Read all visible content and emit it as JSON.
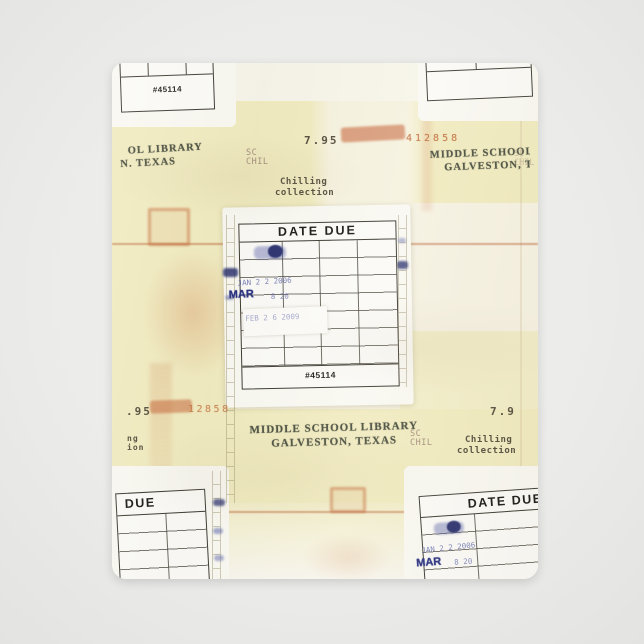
{
  "scene": {
    "subject": "Fleece blanket printed with a vintage library date-due book pocket collage",
    "background_color": "#ececea",
    "blanket_cream": "#f6f2df",
    "tile_yellow": "#f1ebc0",
    "card_paper": "#fbfaf6",
    "ink_dark": "#3f3c33",
    "stamp_green_ink": "#4c5140",
    "stamp_red": "#bf6330",
    "stamp_blue": "#5f68ab",
    "stain_rust": "#c66c38"
  },
  "cards": {
    "center": {
      "header": "DATE DUE",
      "footer": "#45114",
      "stamps": {
        "jan": "JAN 2 2 2006",
        "mar_month": "MAR",
        "mar_rest": "8 20",
        "feb": "FEB 2 6 2009"
      }
    },
    "top_left": {
      "footer": "#45114"
    },
    "bottom_left": {
      "header_fragment": "DUE"
    },
    "bottom_right": {
      "header": "DATE DUE",
      "stamps": {
        "jan": "JAN 2 2 2006",
        "mar_month": "MAR",
        "mar_rest": "8 20"
      }
    }
  },
  "pocket": {
    "library_stamp": {
      "line1": "MIDDLE SCHOOL LIBRARY",
      "line2": "GALVESTON, TEXAS"
    },
    "library_stamp_fragment": {
      "line1": "OL LIBRARY",
      "line2": "N. TEXAS"
    },
    "call_number": {
      "line1": "SC",
      "line2": "CHIL"
    },
    "collection": {
      "line1": "Chilling",
      "line2": "collection"
    },
    "collection_fragment": {
      "line1": "ng",
      "line2": "ion"
    },
    "price": "7.95",
    "price_fragment": ".95",
    "price_fragment_right": "7.9",
    "accession": "412858",
    "accession_fragment": "12858"
  }
}
